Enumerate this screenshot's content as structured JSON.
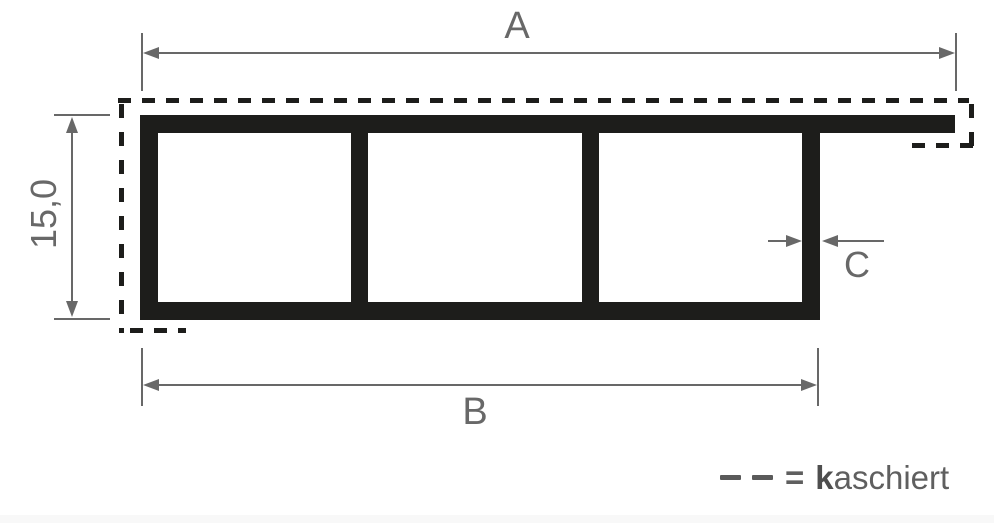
{
  "figure": {
    "type": "profile-cross-section-drawing",
    "dimensions": {
      "overall_width": {
        "label": "A"
      },
      "height": {
        "label": "15,0"
      },
      "body_width": {
        "label": "B"
      },
      "wall_thickness": {
        "label": "C"
      }
    },
    "legend": {
      "equals_sign": "=",
      "term_initial": "k",
      "term_rest": "aschiert"
    },
    "profile": {
      "chambers": 3,
      "flange_side": "right"
    },
    "colors": {
      "profile_black": "#1d1d1b",
      "dashed_black": "#1d1d1b",
      "dimension_gray": "#686868",
      "legend_gray": "#5f5f5f",
      "background": "#ffffff"
    }
  }
}
